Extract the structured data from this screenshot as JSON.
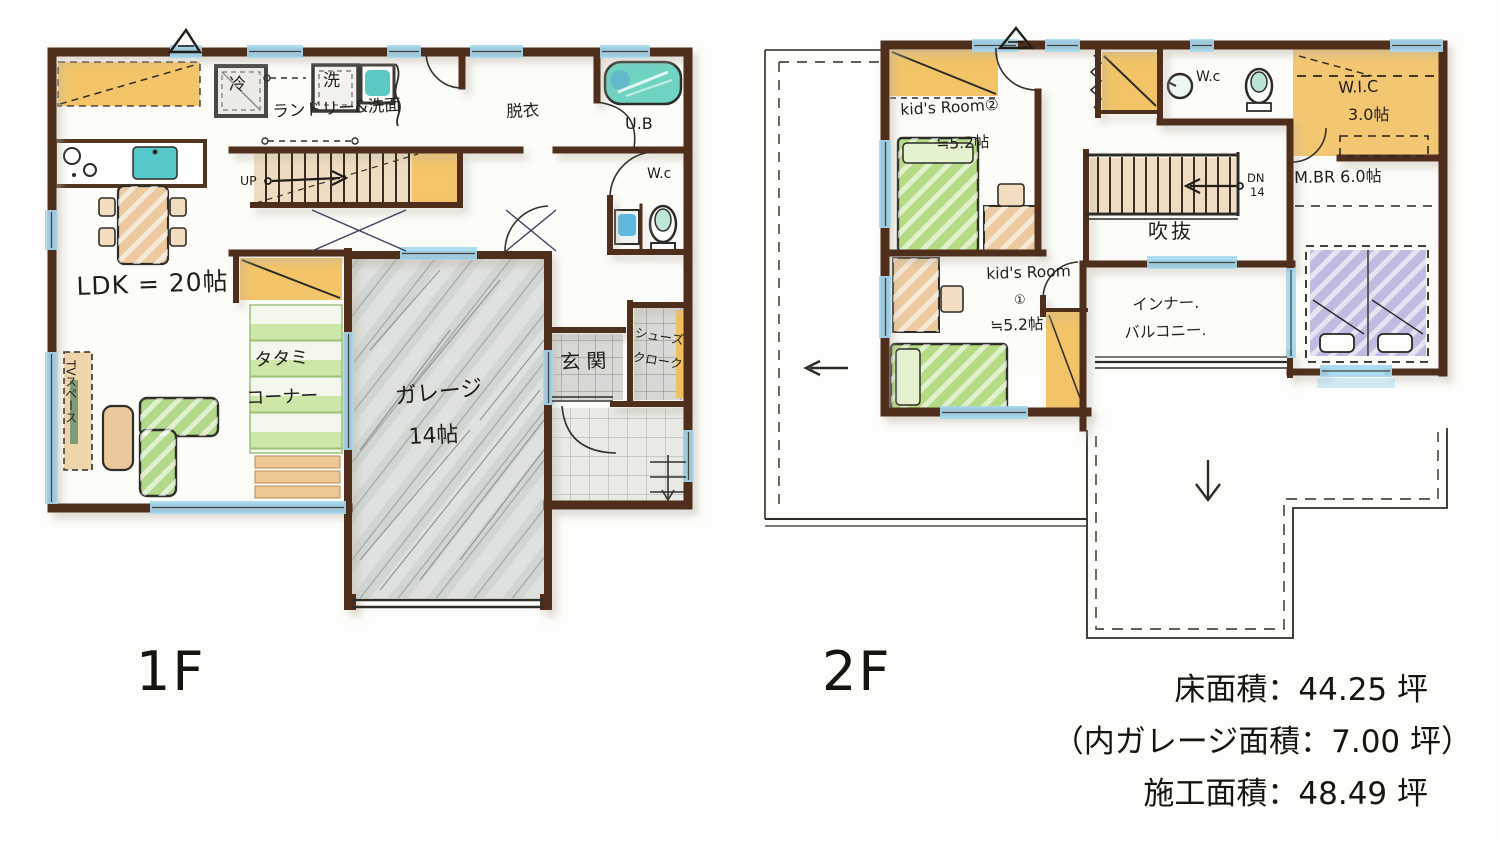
{
  "floor1": {
    "label": "1F",
    "rooms": {
      "ldk": "LDK = 20帖",
      "tv_space": "TVスペース",
      "tatami_1": "タタミ",
      "tatami_2": "コーナー",
      "garage_1": "ガレージ",
      "garage_2": "14帖",
      "entrance": "玄関",
      "shoes_1": "シューズ",
      "shoes_2": "クローク",
      "laundry": "ランドリー&洗面",
      "undressing": "脱衣",
      "unit_bath": "U.B",
      "toilet": "W.c",
      "refrigerator": "冷",
      "washer": "洗",
      "stairs_up": "UP"
    }
  },
  "floor2": {
    "label": "2F",
    "rooms": {
      "kids2_1": "kid's Room②",
      "kids2_2": "≒5.2帖",
      "kids1_1": "kid's Room",
      "kids1_2": "①",
      "kids1_3": "≒5.2帖",
      "toilet": "W.c",
      "wic_1": "W.I.C",
      "wic_2": "3.0帖",
      "master": "M.BR 6.0帖",
      "void": "吹抜",
      "stairs_dn": "DN",
      "stairs_dn_count": "14",
      "balcony_1": "インナー.",
      "balcony_2": "バルコニー."
    }
  },
  "summary": {
    "floor_area": "床面積：44.25 坪",
    "garage_area": "（内ガレージ面積：7.00 坪）",
    "construction_area": "施工面積：48.49 坪"
  },
  "colors": {
    "wall_brown": "#4f2f1a",
    "window_blue": "#a6d8ee",
    "closet_yellow": "#f2c367",
    "tatami_green": "#cde7a9",
    "bed_green": "#b5dc84",
    "wood_tan": "#ecc99e",
    "garage_gray": "#d2d6d3",
    "bath_teal": "#5fc9c0",
    "bed_lavender": "#c1bbe2",
    "ink": "#211e19"
  }
}
